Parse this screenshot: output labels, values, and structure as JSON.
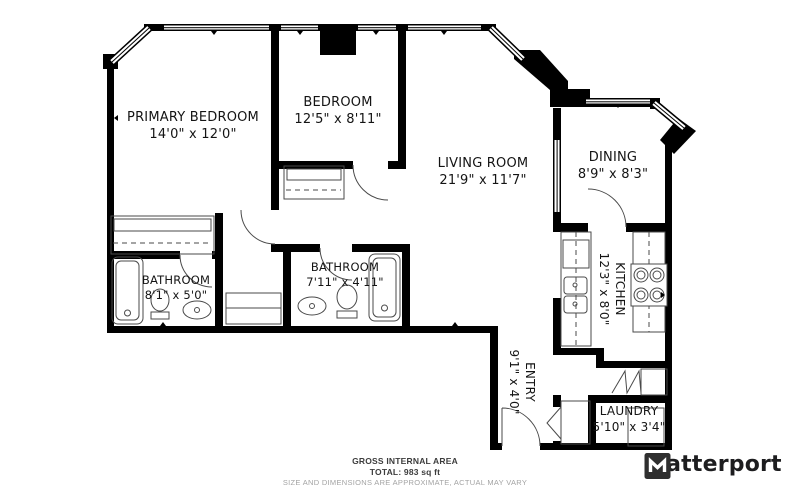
{
  "floorplan": {
    "rooms": [
      {
        "name": "PRIMARY BEDROOM",
        "dims": "14'0\" x 12'0\""
      },
      {
        "name": "BEDROOM",
        "dims": "12'5\" x 8'11\""
      },
      {
        "name": "LIVING ROOM",
        "dims": "21'9\" x 11'7\""
      },
      {
        "name": "DINING",
        "dims": "8'9\" x 8'3\""
      },
      {
        "name": "KITCHEN",
        "dims": "12'3\" x 8'0\""
      },
      {
        "name": "BATHROOM",
        "dims": "8'1\" x 5'0\""
      },
      {
        "name": "BATHROOM",
        "dims": "7'11\" x 4'11\""
      },
      {
        "name": "ENTRY",
        "dims": "9'1\" x 4'0\""
      },
      {
        "name": "LAUNDRY",
        "dims": "5'10\" x 3'4\""
      }
    ],
    "footer": {
      "line1": "GROSS INTERNAL AREA",
      "line2": "TOTAL: 983 sq ft",
      "line3": "SIZE AND DIMENSIONS ARE APPROXIMATE, ACTUAL MAY VARY"
    },
    "brand": {
      "name": "Matterport"
    },
    "colors": {
      "wall": "#000000",
      "background": "#ffffff",
      "fixture_line": "#4a4a4a"
    }
  }
}
